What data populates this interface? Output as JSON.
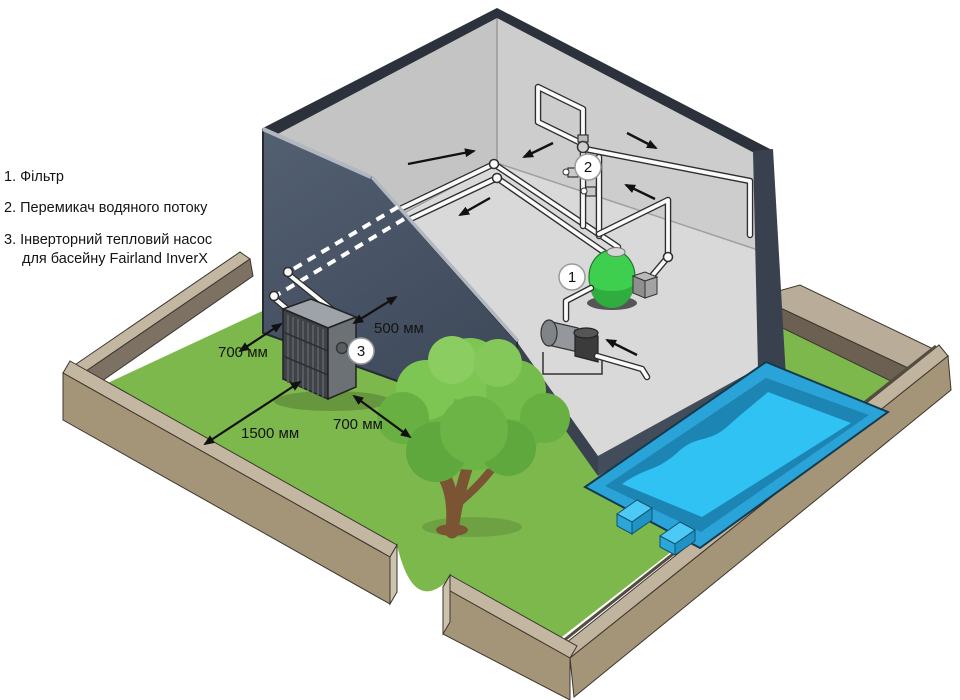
{
  "title": "Fairland InverX pool heat pump installation diagram",
  "legend": {
    "lines": [
      "1. Фільтр",
      "2. Перемикач водяного потоку",
      "3. Інверторний тепловий насос",
      "для басейну Fairland InverX"
    ]
  },
  "dimensions": {
    "pipe_to_wall": "500 мм",
    "side_clearance": "700 мм",
    "front_clearance": "1500 мм",
    "right_clearance": "700 мм"
  },
  "badges": {
    "filter": "1",
    "flow_switch": "2",
    "heat_pump": "3"
  },
  "colors": {
    "grass": "#7db84c",
    "pool_water": "#2fc2f3",
    "pool_coping": "#2aa3d9",
    "pool_wall": "#1d85b4",
    "yard_wall_top": "#c3b7a2",
    "yard_wall_side": "#a49579",
    "yard_wall_inner": "#5f564a",
    "building_dark_wall": "#46526200",
    "building_interior": "#c6c6c6",
    "building_floor": "#d9d9d9",
    "filter_green": "#3ecf4f",
    "heat_pump_front": "#3f4347",
    "pipe_white": "#fafafa"
  }
}
